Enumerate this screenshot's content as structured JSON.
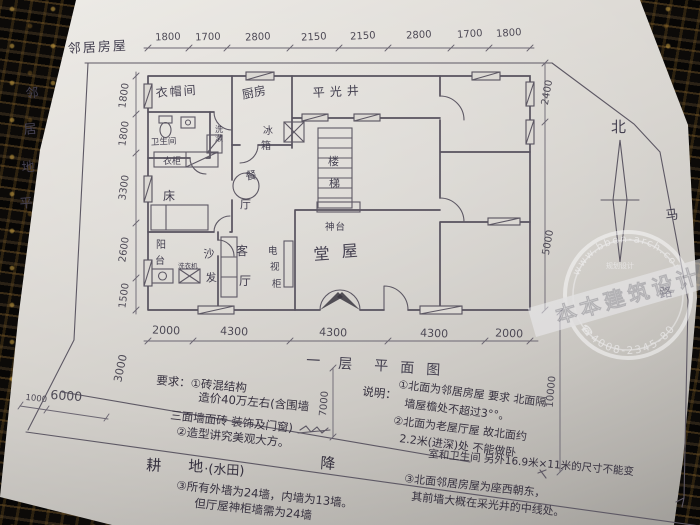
{
  "colors": {
    "paper": "#d8d5d0",
    "pencil": "#57525e",
    "ink": "#36313f",
    "table_cloth": "#0a0807",
    "stamp": "#fbfbfd"
  },
  "labels": {
    "neighbor_house": "邻居房屋",
    "neighbor_ground": [
      "邻",
      "居",
      "地",
      "平"
    ],
    "north": "北",
    "road": [
      "马",
      "路"
    ]
  },
  "dims": {
    "top": [
      "1800",
      "1700",
      "2800",
      "2150",
      "2150",
      "2800",
      "1700",
      "1800"
    ],
    "left": [
      "1800",
      "1800",
      "3300",
      "2600",
      "1500"
    ],
    "bottom": [
      "2000",
      "4300",
      "4300",
      "4300",
      "2000"
    ],
    "right": [
      "2400",
      "5000"
    ],
    "site": {
      "right_depth": "10000",
      "front": "7000",
      "left_gap": "3000",
      "left_a": "1000",
      "left_b": "6000"
    }
  },
  "rooms": {
    "cloakroom": "衣帽间",
    "kitchen": "厨房",
    "lightwell": "平光井",
    "bathroom": "卫生间",
    "washstand": [
      "洗",
      "漱"
    ],
    "wardrobe": "衣柜",
    "bed": "床",
    "dining": [
      "餐",
      "厅"
    ],
    "fridge": [
      "冰",
      "箱"
    ],
    "stairs": [
      "楼",
      "梯"
    ],
    "balcony": [
      "阳",
      "台"
    ],
    "washer": "洗衣机",
    "sofa": [
      "沙",
      "发"
    ],
    "living": [
      "客",
      "厅"
    ],
    "tv_cabinet": [
      "电",
      "视",
      "柜"
    ],
    "altar": "神台",
    "hall": [
      "堂",
      "屋"
    ]
  },
  "title": [
    "一",
    "层",
    "平",
    "面",
    "图"
  ],
  "requirements": {
    "l1": "要求：①砖混结构",
    "l2": "造价40万左右(含围墙",
    "l3": "三面墙面砖 装饰及门窗)",
    "l4": "②造型讲究美观大方。",
    "l5": "③所有外墙为24墙，内墙为13墙。",
    "l6": "但厅屋神柜墙需为24墙"
  },
  "site_text": {
    "field": "耕",
    "field2": "地",
    "paddy": "·(水田)",
    "drop": "降"
  },
  "notes": {
    "head": "说明：",
    "n1a": "①北面为邻居房屋 要求 北面隔",
    "n1b": "墙屋檐处不超过3°°。",
    "n2a": "②北面为老屋厅屋 故北面约",
    "n2b": "2.2米(进深)处 不能做卧",
    "n2c": "室和卫生间 另外16.9米×11米的尺寸不能变",
    "n3a": "③北面邻居房屋为座西朝东，",
    "n3b": "其前墙大概在采光井的中线处。"
  },
  "watermark": {
    "url": "www.bben-arch.com",
    "brand": "本本建筑设计",
    "phone": "☎4008-2345-80",
    "small": "规划设计"
  }
}
